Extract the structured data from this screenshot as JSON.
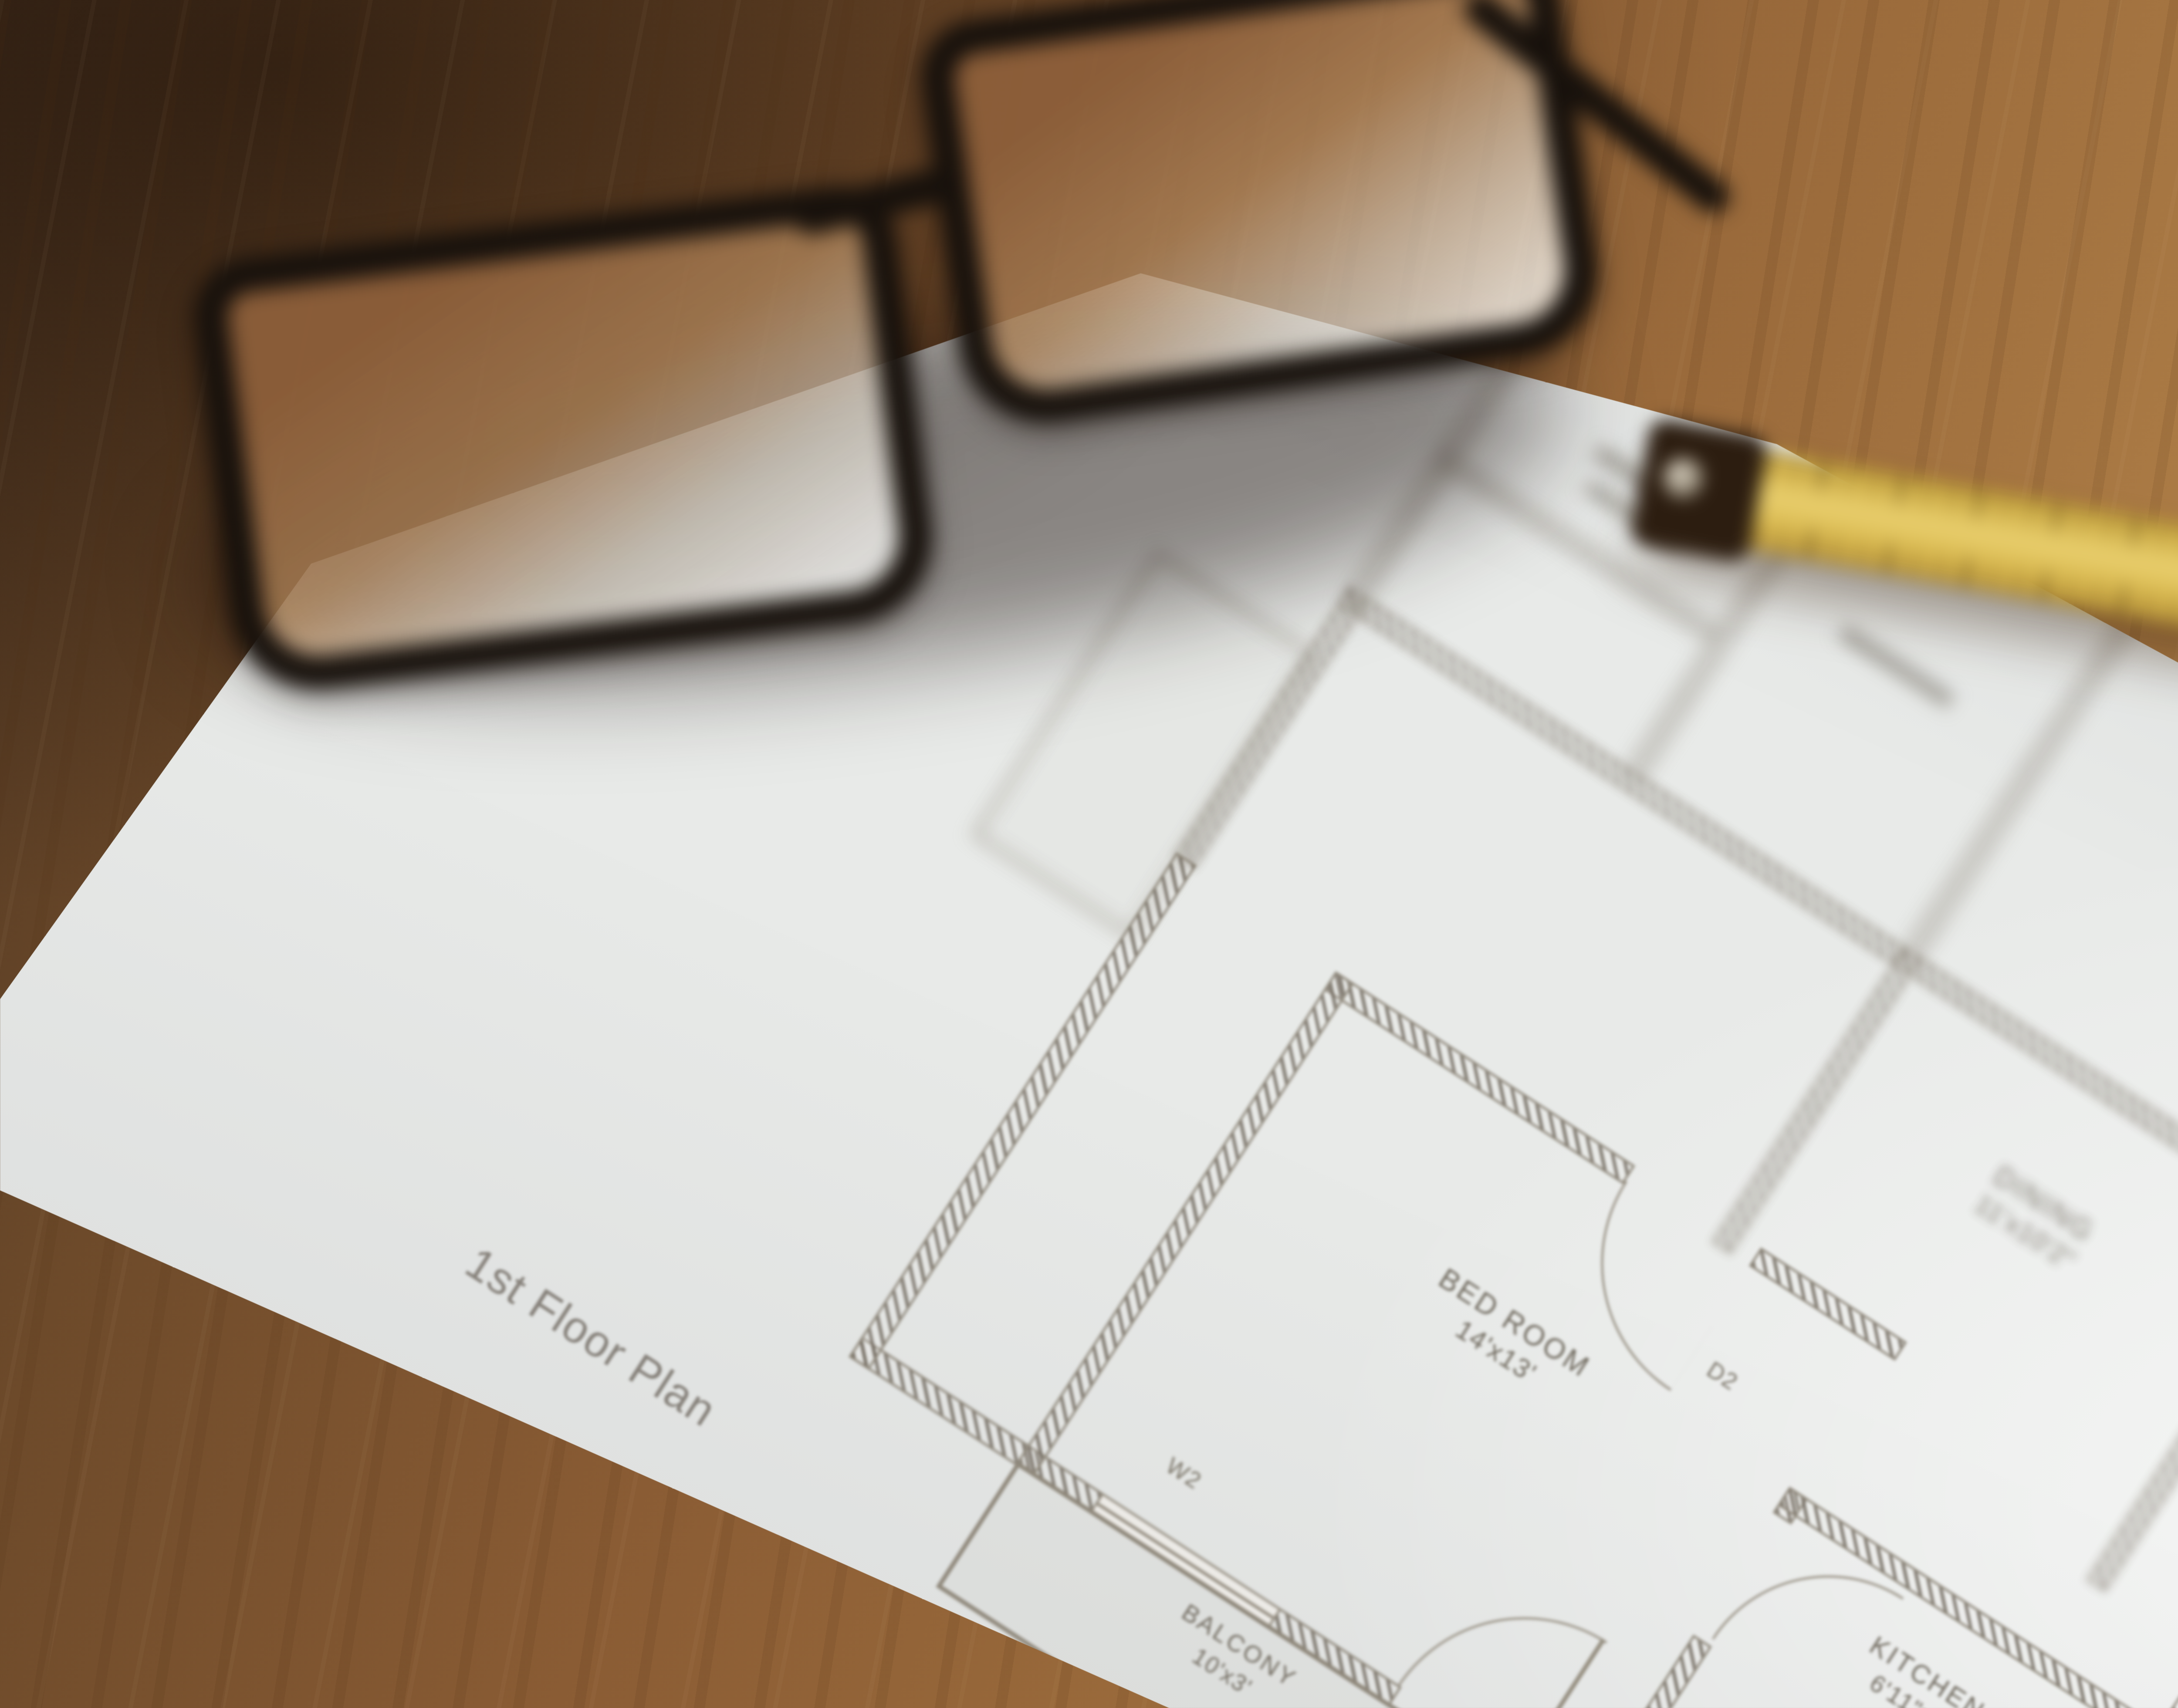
{
  "scene": {
    "description": "Photo of an architectural floor plan sheet on a wooden desk, with black eyeglasses, a yellow folding ruler, a black-and-orange tape measure and a black pen laid on top",
    "colors": {
      "wood_dark": "#4a3320",
      "wood_light": "#cfa76d",
      "paper": "#e8eae8",
      "plan_ink": "#8f887b",
      "ruler_yellow": "#dcbd56",
      "tape_accent_orange": "#d4572c",
      "pen_black": "#0c0805"
    }
  },
  "plan": {
    "title": "1st Floor Plan",
    "rooms": [
      {
        "name": "BED ROOM",
        "size": "14'x13'"
      },
      {
        "name": "KITCHEN",
        "size": "6'11\"x7'"
      },
      {
        "name": "BED ROOM",
        "size": "13'x15'"
      },
      {
        "name": "DINING",
        "size": "11'x10'2\""
      },
      {
        "name": "BED ROOM",
        "size": "13'x19'8\""
      },
      {
        "name": "BALCONY",
        "size": "10'x3'"
      },
      {
        "name": "BALCONY",
        "size": "9'x3'6\""
      }
    ],
    "door_labels": {
      "d2": "D2",
      "d3": "D3"
    },
    "window_labels": {
      "w1": "W1",
      "w2": "W2",
      "w3": "W3"
    }
  }
}
